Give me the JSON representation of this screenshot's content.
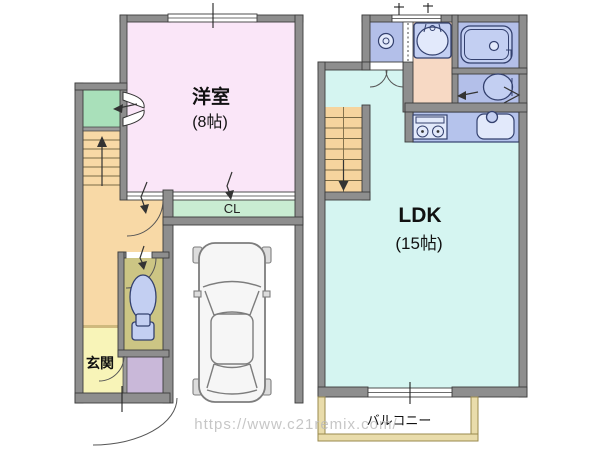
{
  "watermark": {
    "text": "https://www.c21remix.com/",
    "color": "#b9b9b9"
  },
  "units": {
    "left": {
      "rooms": {
        "western_room": {
          "label": "洋室",
          "size_label": "(8帖)",
          "floor_color": "#fae6f8"
        },
        "closet_cl": {
          "label": "CL",
          "floor_color": "#c9ecd2"
        },
        "entrance": {
          "label": "玄関",
          "floor_color": "#f8f4b8"
        },
        "hallway": {
          "floor_color": "#f8d9a6"
        },
        "side_closet": {
          "floor_color": "#a9e0ba"
        },
        "toilet": {
          "floor_color": "#ccc584"
        },
        "storage": {
          "floor_color": "#c9b8d9"
        },
        "garage": {
          "floor_color": "#ffffff"
        }
      }
    },
    "right": {
      "rooms": {
        "ldk": {
          "label": "LDK",
          "size_label": "(15帖)",
          "floor_color": "#d5f5f1"
        },
        "balcony": {
          "label": "バルコニー",
          "wall_color": "#e9dcab"
        },
        "washer_space": {
          "floor_color": "#b3bfe9"
        },
        "washroom": {
          "floor_color": "#f7d9c4"
        },
        "bathroom": {
          "floor_color": "#b3bfe9"
        },
        "toilet": {
          "floor_color": "#b3bfe9"
        },
        "kitchen": {
          "counter_color": "#b5c3ec"
        },
        "stairs": {
          "color": "#f6d49e"
        }
      }
    }
  },
  "walls": {
    "color": "#8e8e8e",
    "outline": "#3c3c3c"
  }
}
